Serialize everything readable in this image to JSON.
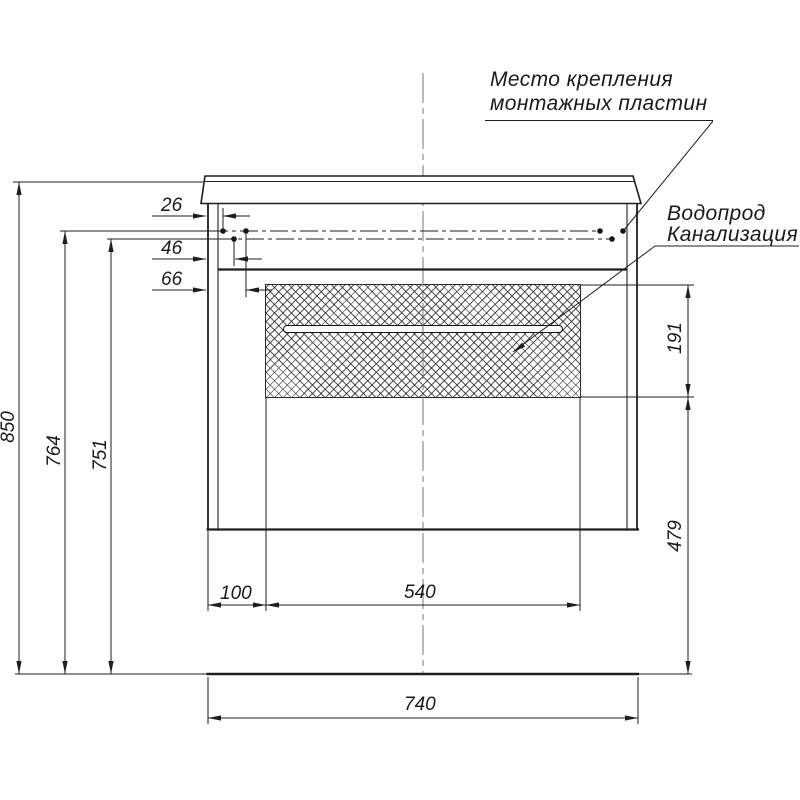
{
  "notes": {
    "mounting_plates": {
      "line1": "Место крепления",
      "line2": "монтажных пластин"
    },
    "plumbing": {
      "line1": "Водопрод",
      "line2": "Канализация"
    }
  },
  "dimensions_mm": {
    "total_height": "850",
    "mount_line_upper": "764",
    "mount_line_lower": "751",
    "mount_offset_1": "26",
    "mount_offset_2": "46",
    "mount_offset_3": "66",
    "niche_offset_left": "100",
    "niche_width": "540",
    "cabinet_width": "740",
    "niche_height": "191",
    "niche_to_floor": "479"
  },
  "colors": {
    "line": "#1e1e1e",
    "centerline": "#777777",
    "background": "#ffffff"
  }
}
